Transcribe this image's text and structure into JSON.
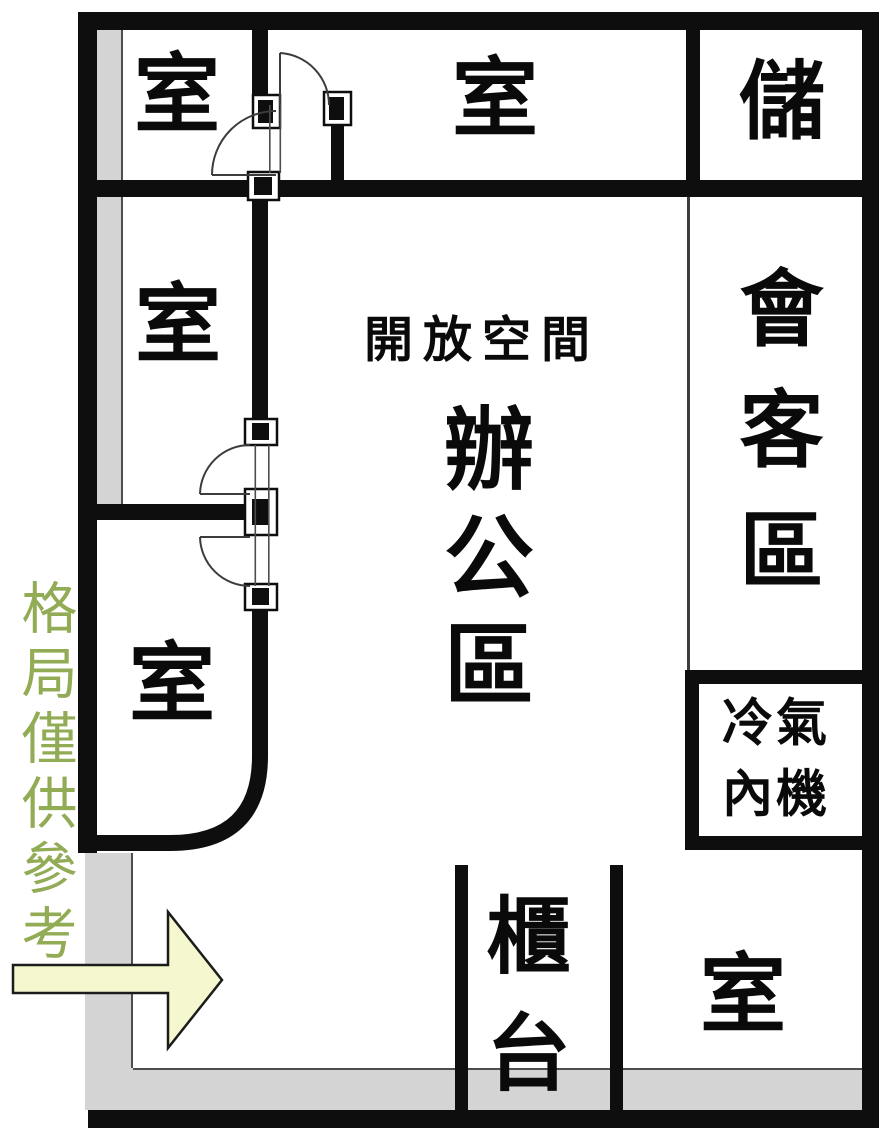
{
  "plan": {
    "labels": {
      "room_top_left": "室",
      "room_top_middle": "室",
      "storage_room": "儲",
      "room_mid_left": "室",
      "open_space_title": "開放空間",
      "open_space_name": "辦公區",
      "meeting_area": "會客區",
      "ac_indoor_unit": "冷氣內機",
      "room_bottom_left": "室",
      "counter": "櫃台",
      "room_bottom_right": "室"
    },
    "watermark": "格局僅供參考",
    "icons": {
      "entrance_arrow": "entrance-direction-arrow"
    }
  },
  "colors": {
    "wall": "#0e0e0e",
    "floor": "#ffffff",
    "gray_zone": "#d4d4d4",
    "gray_edge": "#4d4d4d",
    "door_line": "#3c3c3c",
    "arrow_fill": "#f5f7cf",
    "arrow_border": "#1c1c1c",
    "watermark_green": "#92ab55",
    "label_text": "#0a0a0a"
  }
}
